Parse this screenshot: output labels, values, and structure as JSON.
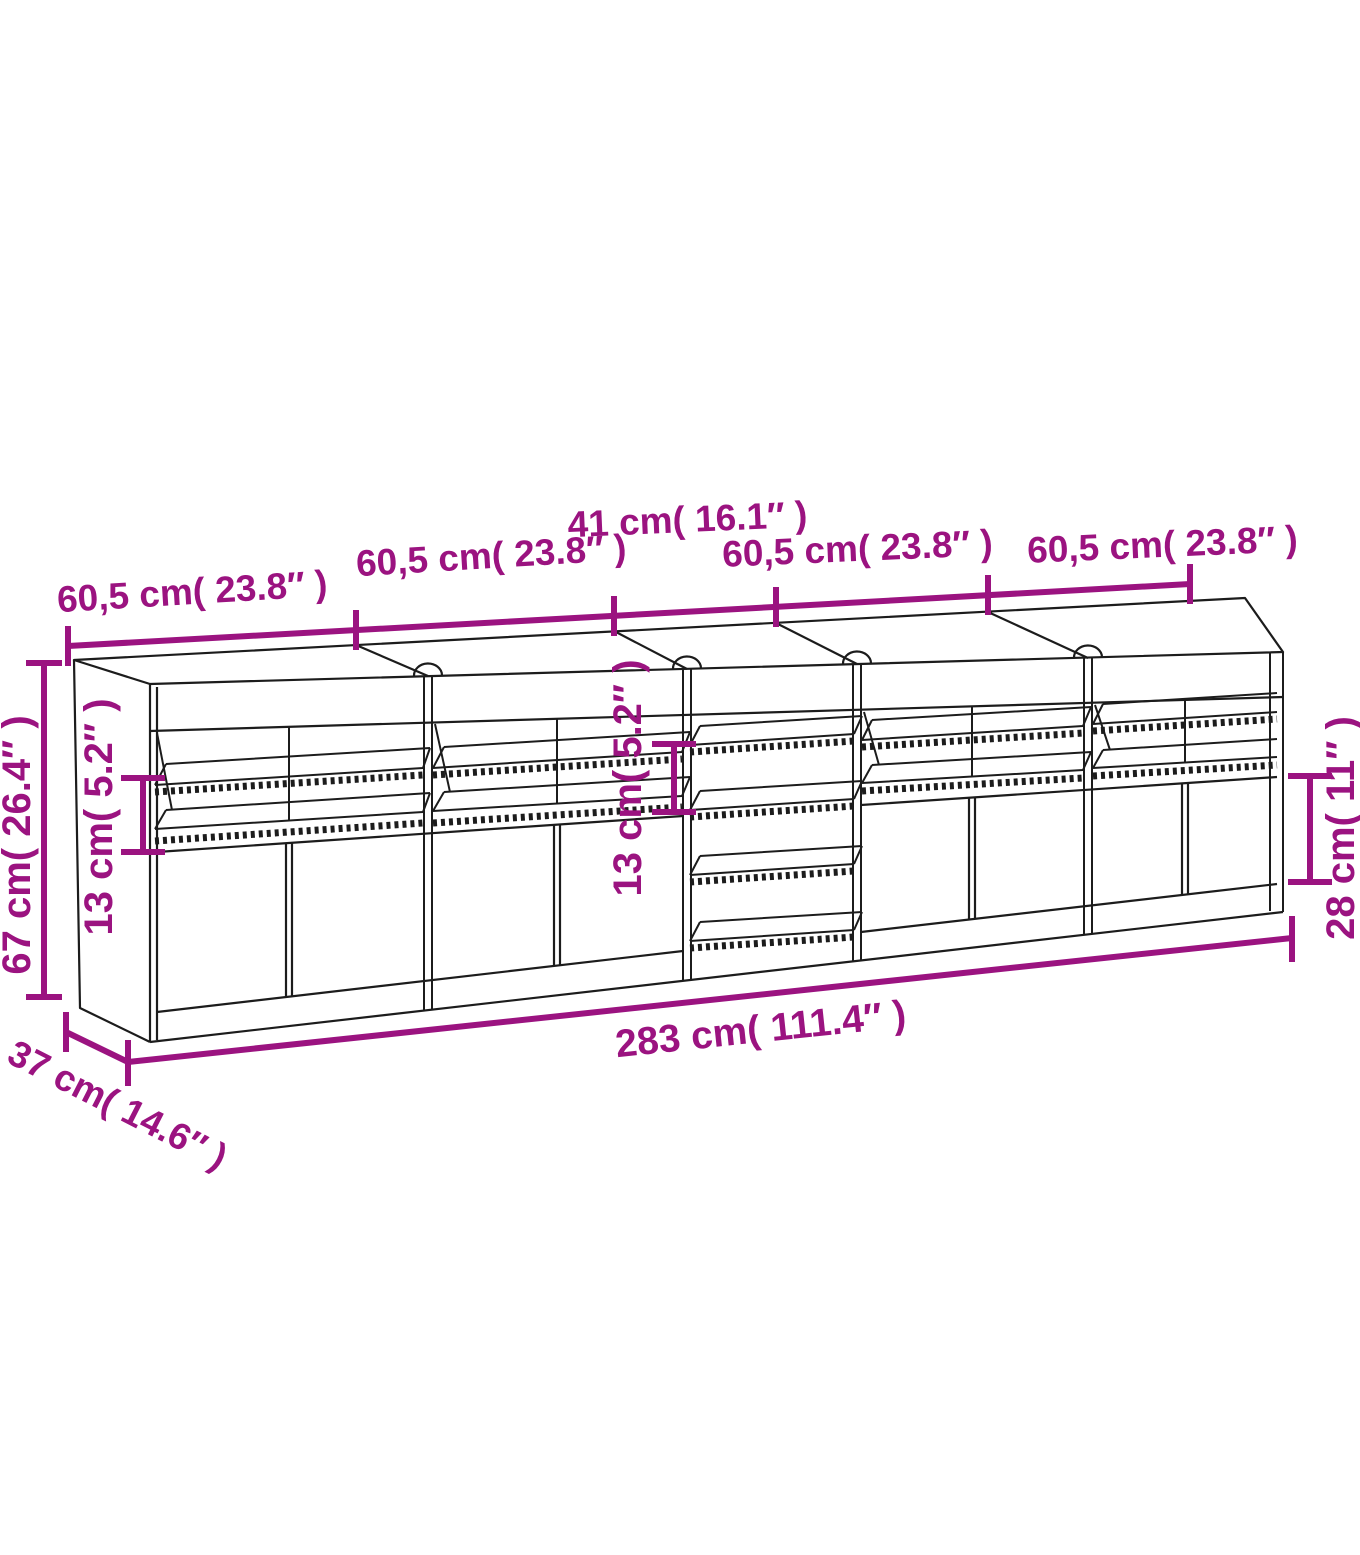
{
  "diagram": {
    "type": "furniture-dimension-drawing",
    "subject": "sideboard with five cabinet units, glass shelves and doors",
    "colors": {
      "accent": "#9B1380",
      "line": "#1C1C1C",
      "background": "#FFFFFF"
    },
    "dimensions": {
      "top_segments": [
        {
          "position": "far-left",
          "label": "60,5 cm( 23.8″ )"
        },
        {
          "position": "left-center",
          "label": "60,5 cm( 23.8″ )"
        },
        {
          "position": "right-center",
          "label": "60,5 cm( 23.8″ )"
        },
        {
          "position": "far-right",
          "label": "60,5 cm( 23.8″ )"
        }
      ],
      "middle_unit_width": {
        "label": "41 cm( 16.1″ )"
      },
      "overall_height": {
        "label": "67 cm( 26.4″ )"
      },
      "shelf_gap_left": {
        "label": "13 cm( 5.2″ )"
      },
      "shelf_gap_middle": {
        "label": "13 cm( 5.2″ )"
      },
      "door_height_right": {
        "label": "28 cm( 11″ )"
      },
      "overall_width": {
        "label": "283 cm( 111.4″ )"
      },
      "depth": {
        "label": "37 cm( 14.6″ )"
      }
    }
  }
}
